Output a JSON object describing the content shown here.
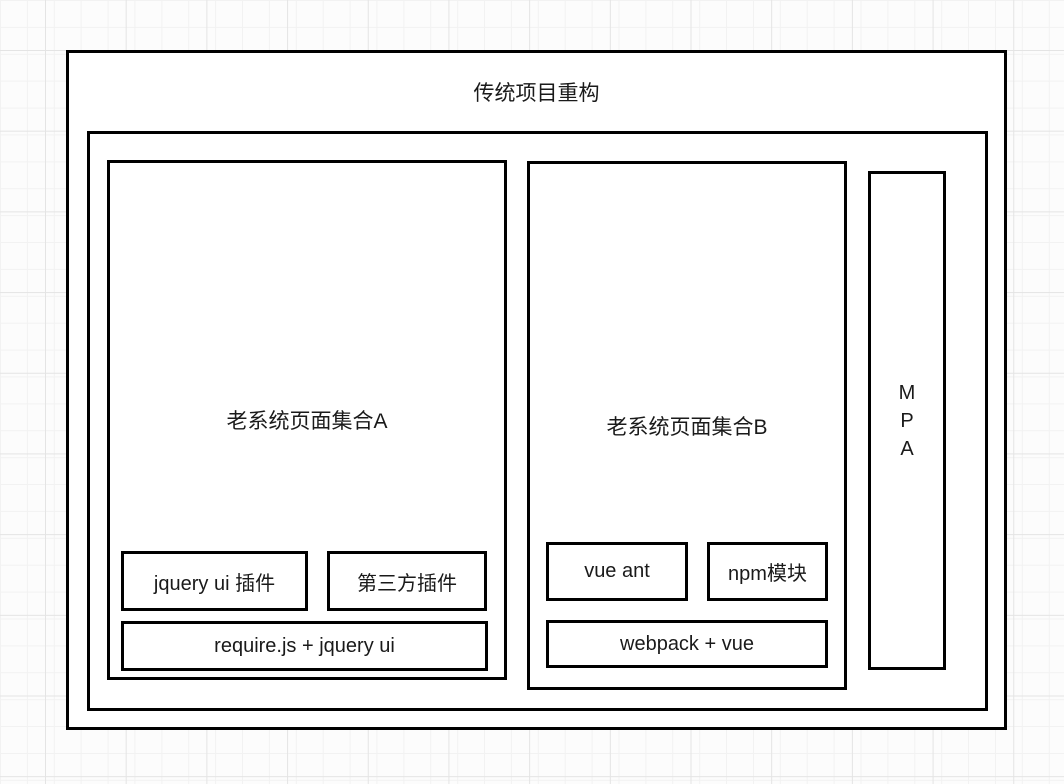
{
  "diagram": {
    "title": "传统项目重构",
    "group_a": {
      "label": "老系统页面集合A",
      "plugin_1": "jquery ui 插件",
      "plugin_2": "第三方插件",
      "base": "require.js + jquery ui"
    },
    "group_b": {
      "label": "老系统页面集合B",
      "plugin_1": "vue ant",
      "plugin_2": "npm模块",
      "base": "webpack + vue"
    },
    "mpa": {
      "label": "M\nP\nA"
    }
  },
  "colors": {
    "border": "#000000",
    "box_fill": "#ffffff",
    "text": "#1a1a1a",
    "canvas_background": "#fcfcfc",
    "grid_minor": "#f2f2f2",
    "grid_major": "#e4e4e4"
  }
}
